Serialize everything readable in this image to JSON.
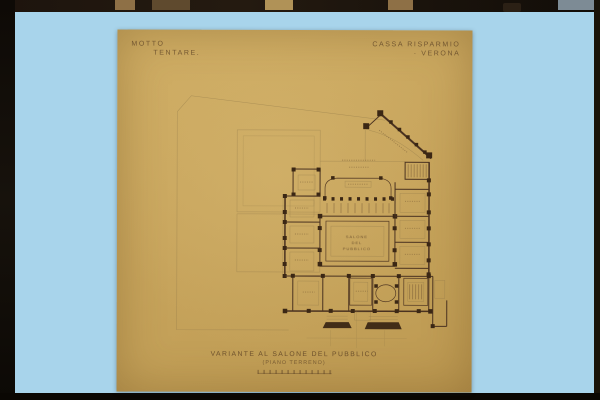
{
  "slide": {
    "background_color": "#a8d4eb",
    "film_edge_color": "#17110b"
  },
  "sheet": {
    "paper_color": "#c8a55d",
    "ink_color": "#4a3220",
    "header": {
      "motto_label": "MOTTO",
      "motto_value": "TENTARE.",
      "client_line1": "CASSA RISPARMIO",
      "client_line2": "· VERONA"
    },
    "plan": {
      "hall_label": [
        "SALONE",
        "DEL",
        "PUBBLICO"
      ]
    },
    "caption": {
      "title": "VARIANTE AL SALONE DEL PUBBLICO",
      "subtitle": "(PIANO TERRENO)"
    }
  }
}
